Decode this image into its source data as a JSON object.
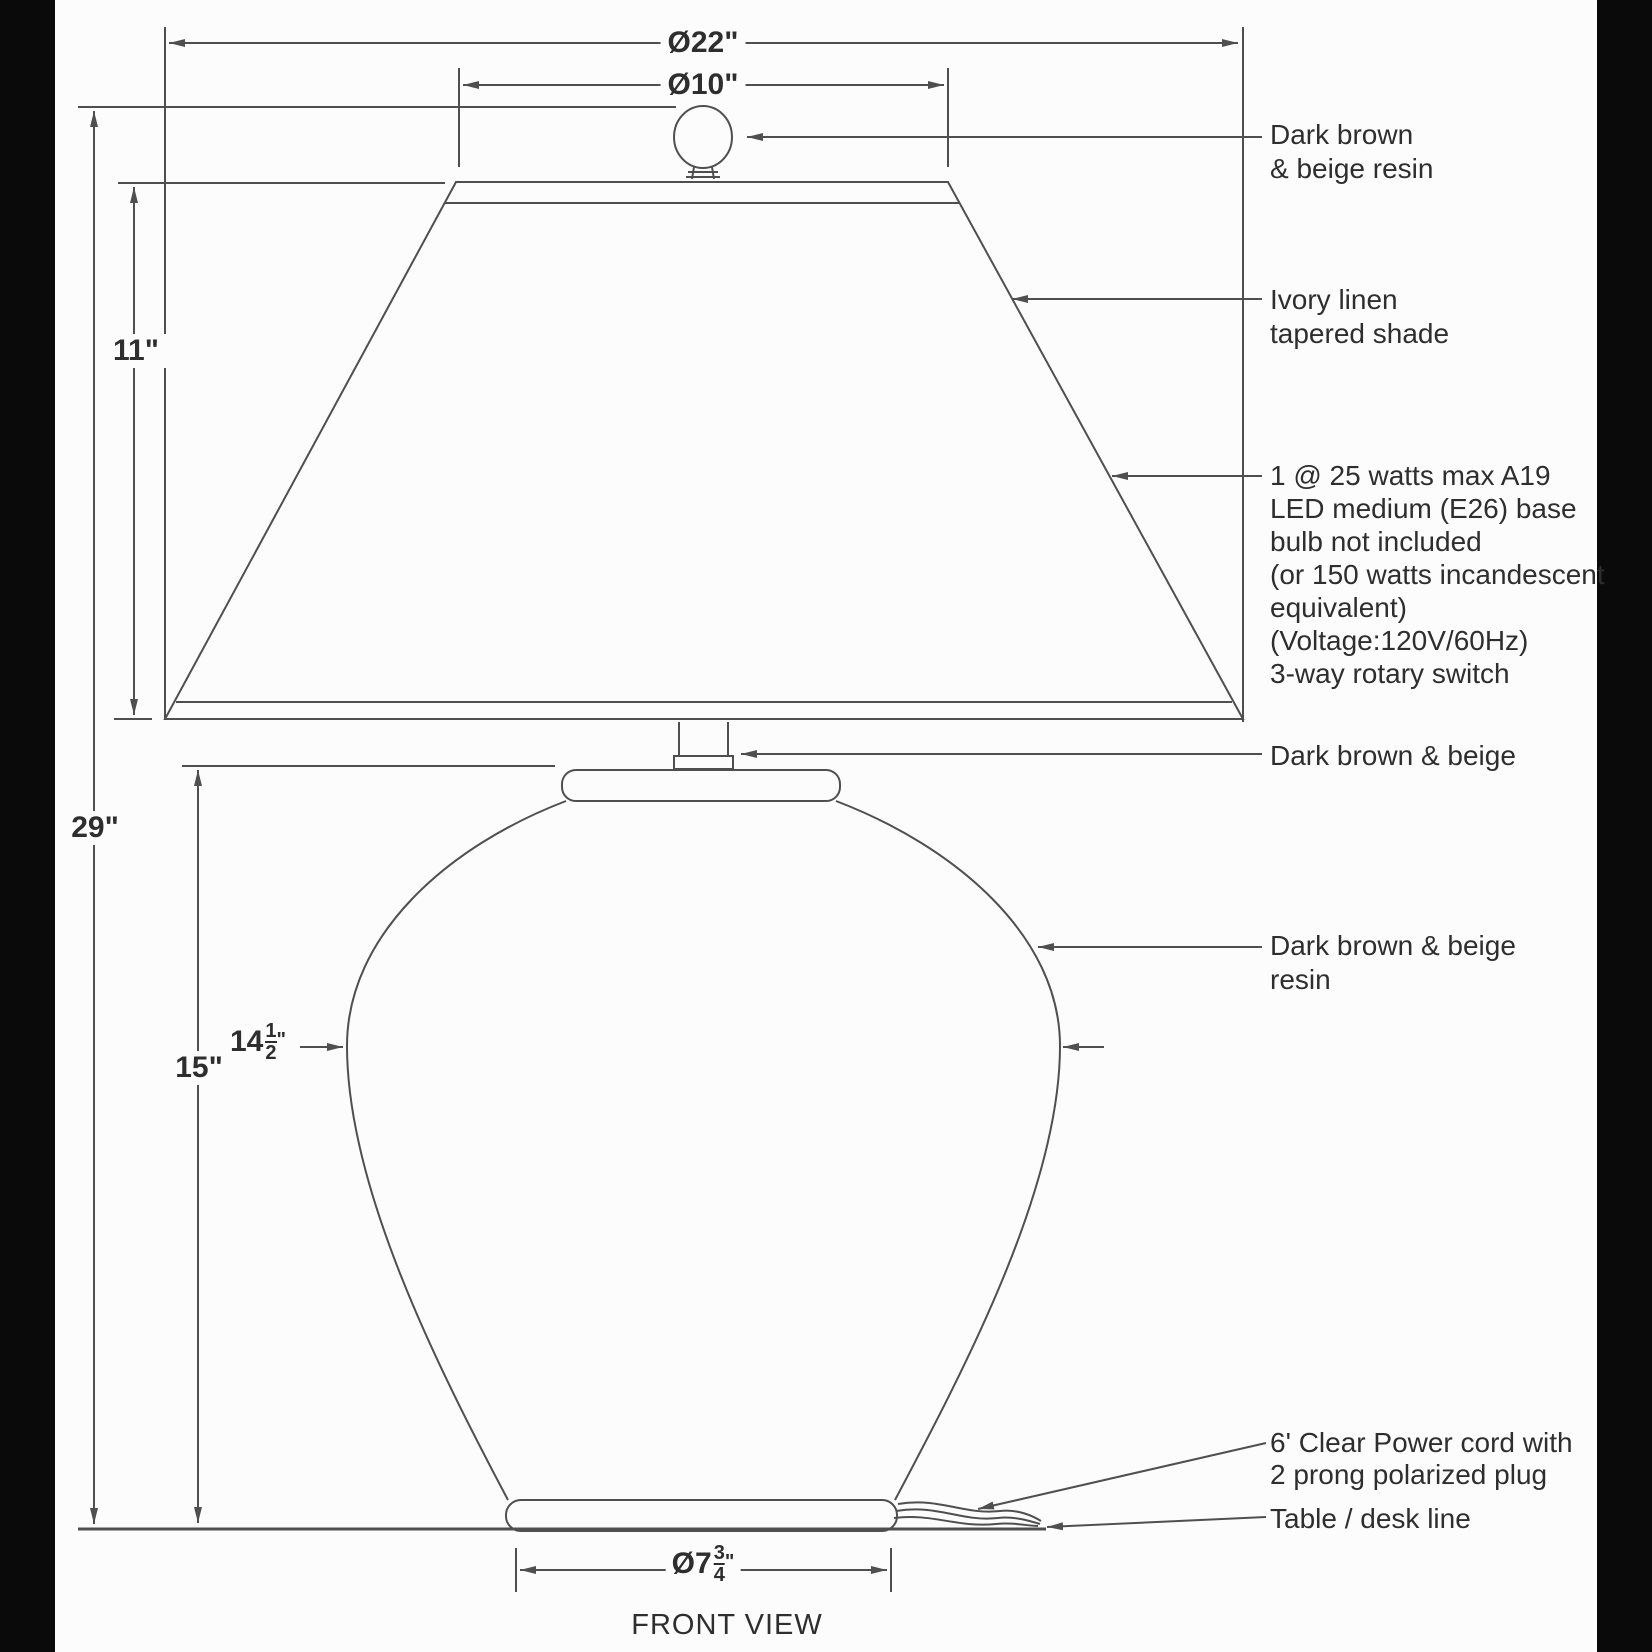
{
  "title": "Table lamp dimensional drawing",
  "view_label": "FRONT VIEW",
  "dims": {
    "shade_bottom_diameter": "Ø22\"",
    "shade_top_diameter": "Ø10\"",
    "shade_height": "11\"",
    "total_height": "29\"",
    "body_height": "15\"",
    "body_diameter": {
      "prefix": "14",
      "numerator": "1",
      "denominator": "2",
      "unit": "\""
    },
    "base_diameter": {
      "prefix": "Ø7",
      "numerator": "3",
      "denominator": "4",
      "unit": "\""
    }
  },
  "labels": {
    "finial": {
      "line1": "Dark brown",
      "line2": "& beige resin"
    },
    "shade": {
      "line1": "Ivory linen",
      "line2": "tapered shade"
    },
    "bulb": {
      "lines": [
        "1 @ 25 watts max A19",
        "LED medium (E26) base",
        "bulb not included",
        "(or 150 watts incandescent",
        "equivalent)",
        "(Voltage:120V/60Hz)",
        "3-way rotary switch"
      ]
    },
    "neck": "Dark brown & beige",
    "body": {
      "line1": "Dark brown & beige",
      "line2": "resin"
    },
    "cord": {
      "line1": "6' Clear Power cord with",
      "line2": "2 prong polarized plug"
    },
    "table": "Table / desk line"
  },
  "colors": {
    "line": "#4f4f4f",
    "text": "#2e2e2e",
    "background": "#fcfcfc",
    "edge_band": "#0a0a0a"
  }
}
